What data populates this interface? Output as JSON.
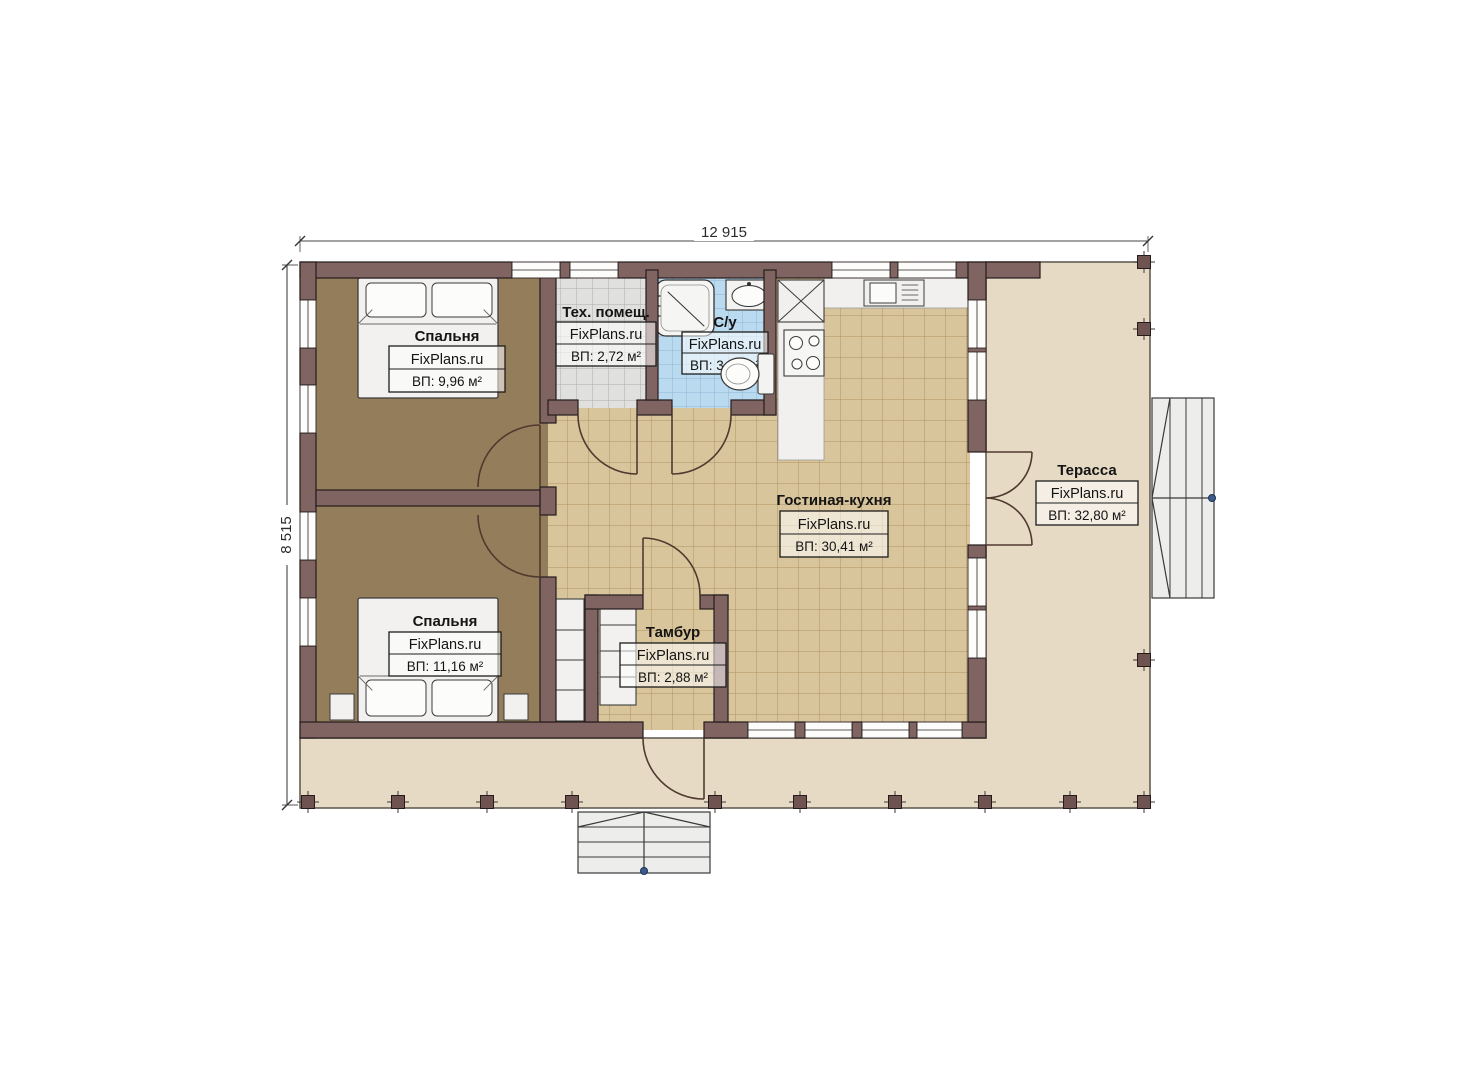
{
  "plan": {
    "dimensions": {
      "width": "12 915",
      "height": "8 515"
    },
    "watermark": "FixPlans.ru",
    "rooms": [
      {
        "name": "Спальня",
        "watermark": "FixPlans.ru",
        "area": "ВП: 9,96 м²"
      },
      {
        "name": "Тех. помещ.",
        "watermark": "FixPlans.ru",
        "area": "ВП: 2,72 м²"
      },
      {
        "name": "С/у",
        "watermark": "FixPlans.ru",
        "area": "ВП: 3,23 м²"
      },
      {
        "name": "Гостиная-кухня",
        "watermark": "FixPlans.ru",
        "area": "ВП: 30,41 м²"
      },
      {
        "name": "Терасса",
        "watermark": "FixPlans.ru",
        "area": "ВП: 32,80 м²"
      },
      {
        "name": "Тамбур",
        "watermark": "FixPlans.ru",
        "area": "ВП: 2,88 м²"
      },
      {
        "name": "Спальня",
        "watermark": "FixPlans.ru",
        "area": "ВП: 11,16 м²"
      }
    ],
    "colors": {
      "wall": "#806462",
      "terrace_floor": "#e6dac4",
      "bedroom_floor": "#947d5a",
      "living_tile": "#d9c59c",
      "tech_tile": "#e0e0de",
      "bath_tile": "#badaf0"
    }
  }
}
